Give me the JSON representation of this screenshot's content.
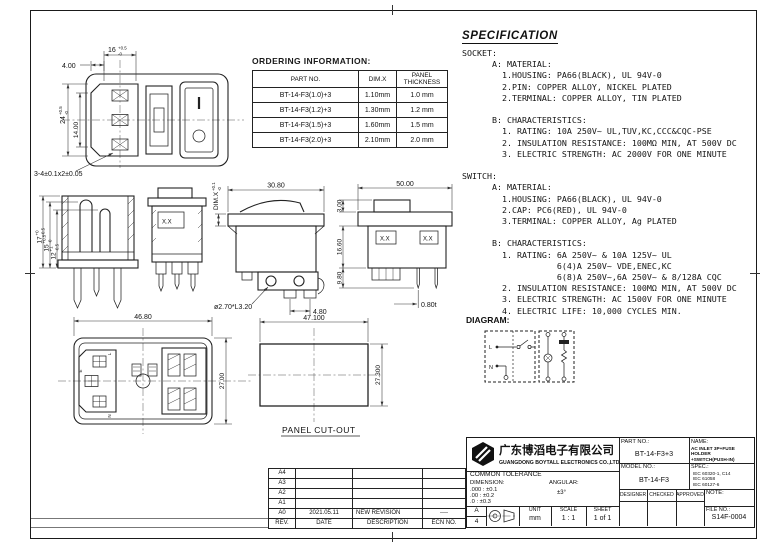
{
  "ordering": {
    "title": "ORDERING INFORMATION:",
    "headers": [
      "PART NO.",
      "DIM.X",
      "PANEL THICKNESS"
    ],
    "rows": [
      [
        "BT-14-F3(1.0)+3",
        "1.10mm",
        "1.0 mm"
      ],
      [
        "BT-14-F3(1.2)+3",
        "1.30mm",
        "1.2 mm"
      ],
      [
        "BT-14-F3(1.5)+3",
        "1.60mm",
        "1.5 mm"
      ],
      [
        "BT-14-F3(2.0)+3",
        "2.10mm",
        "2.0 mm"
      ]
    ]
  },
  "spec": {
    "title": "SPECIFICATION",
    "lines": [
      "SOCKET:",
      "      A: MATERIAL:",
      "        1.HOUSING: PA66(BLACK), UL 94V-0",
      "        2.PIN: COPPER ALLOY, NICKEL PLATED",
      "        2.TERMINAL: COPPER ALLOY, TIN PLATED",
      "",
      "      B: CHARACTERISTICS:",
      "        1. RATING: 10A 250V~ UL,TUV,KC,CCC&CQC-PSE",
      "        2. INSULATION RESISTANCE: 100MΩ MIN, AT 500V DC",
      "        3. ELECTRIC STRENGTH: AC 2000V FOR ONE MINUTE",
      "",
      "SWITCH:",
      "      A: MATERIAL:",
      "        1.HOUSING: PA66(BLACK), UL 94V-0",
      "        2.CAP: PC6(RED), UL 94V-0",
      "        3.TERMINAL: COPPER ALLOY, Ag PLATED",
      "",
      "      B: CHARACTERISTICS:",
      "        1. RATING: 6A 250V~ & 10A 125V~ UL",
      "                   6(4)A 250V~ VDE,ENEC,KC",
      "                   6(8)A 250V~,6A 250V~ & 8/128A CQC",
      "        2. INSULATION RESISTANCE: 100MΩ MIN, AT 500V DC",
      "        3. ELECTRIC STRENGTH: AC 1500V FOR ONE MINUTE",
      "        4. ELECTRIC LIFE: 10,000 CYCLES MIN."
    ],
    "diagram_label": "DIAGRAM:"
  },
  "diagram": {
    "line_label": "L",
    "neutral_label": "N"
  },
  "dims": {
    "front": {
      "w": "16",
      "w_sup": "+0.5",
      "w_sub": "-0",
      "offset": "4.00",
      "h": "24",
      "h_sup": "+0.5",
      "h_sub": "-0",
      "inner_h": "14.00",
      "hole_note": "3-4±0.1x2±0.05"
    },
    "section": {
      "h1": "17",
      "h1_sup": "+0",
      "h1_sub": "-0.5",
      "h2": "15",
      "h2_sup": "+0.5",
      "h2_sub": "-0",
      "h3": "12",
      "h3_sup": "+1",
      "h3_sub": "-0.5"
    },
    "fuse_side": {
      "mark": "X.X"
    },
    "switch_side": {
      "w": "30.80",
      "panel": "DIM.X",
      "panel_sup": "+0.1",
      "panel_sub": "-0",
      "pin_note": "ø2.70*L3.20",
      "pitch": "4.80"
    },
    "top": {
      "w": "50.00",
      "flange": "3.00",
      "body_h": "16.60",
      "pin_h": "9.80",
      "pin_t": "0.80t",
      "mark1": "X.X",
      "mark2": "X.X"
    },
    "rear": {
      "w": "46.80",
      "h": "27.00",
      "l": "L",
      "e": "E",
      "n": "N"
    },
    "cutout": {
      "w": "47.100",
      "h": "27.300",
      "label": "PANEL CUT-OUT"
    }
  },
  "revision": {
    "rows": [
      {
        "rev": "A4",
        "date": "",
        "desc": "",
        "ecn": ""
      },
      {
        "rev": "A3",
        "date": "",
        "desc": "",
        "ecn": ""
      },
      {
        "rev": "A2",
        "date": "",
        "desc": "",
        "ecn": ""
      },
      {
        "rev": "A1",
        "date": "",
        "desc": "",
        "ecn": ""
      },
      {
        "rev": "A0",
        "date": "2021.05.11",
        "desc": "NEW REVISION",
        "ecn": "----"
      }
    ],
    "footer": {
      "rev": "REV.",
      "date": "DATE",
      "desc": "DESCRIPTION",
      "ecn": "ECN NO."
    }
  },
  "title_block": {
    "company_cn": "广东博滔电子有限公司",
    "company_en": "GUANGDONG BOYTALL ELECTRONICS CO.,LTD",
    "part_no_label": "PART NO.:",
    "part_no": "BT-14-F3+3",
    "name_label": "NAME:",
    "name_lines": [
      "AC INLET 3P+FUSE HOLDER",
      "+SWITCH(PUSH-IN)"
    ],
    "model_no_label": "MODEL NO.:",
    "model_no": "BT-14-F3",
    "spec_label": "SPEC.:",
    "spec_lines": [
      "IEC 60320-1, C14",
      "IEC 61058",
      "IEC 60127-6"
    ],
    "designer_label": "DESIGNER",
    "checked_label": "CHECKED",
    "approved_label": "APPROVED",
    "note_label": "NOTE:",
    "file_no_label": "FILE NO.:",
    "file_no": "S14F-0004",
    "tolerance": {
      "title": "COMMON TOLERANCE",
      "dimension_label": "DIMENSION:",
      "angular_label": "ANGULAR:",
      "rows": [
        ".000 : ±0.1",
        ".00  : ±0.2",
        ".0   : ±0.3"
      ],
      "angular_value": "±3°"
    },
    "sheet_size_letter": "A",
    "sheet_size_number": "4",
    "unit_label": "UNIT",
    "unit_value": "mm",
    "scale_label": "SCALE",
    "scale_value": "1 : 1",
    "sheet_label": "SHEET",
    "sheet_value": "1 of 1"
  }
}
